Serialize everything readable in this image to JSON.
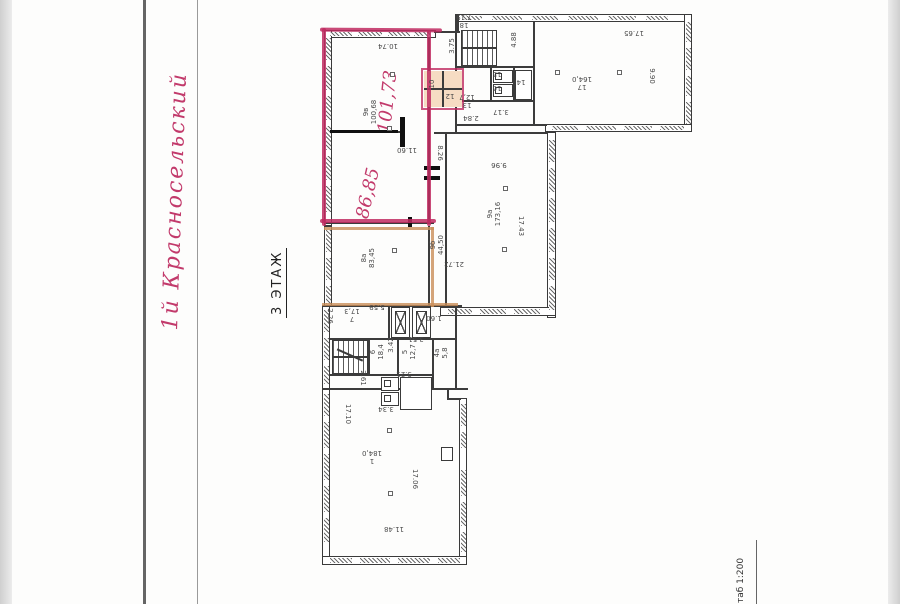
{
  "annotations": {
    "street_handwritten": "1й Красносельский",
    "area_top_handwritten": "101,73",
    "area_bottom_handwritten": "86,85",
    "floor_label": "3 ЭТАЖ",
    "scale_label": "таб 1:200"
  },
  "rooms": [
    {
      "num": "9в",
      "area": "100,68",
      "label": "9в\n100,68"
    },
    {
      "num": "9а",
      "area": "173,16",
      "label": "9а\n173,16"
    },
    {
      "num": "9б",
      "area": "44,50",
      "label": "9б\n44,50"
    },
    {
      "num": "8а",
      "area": "83,45",
      "label": "8а\n83,45"
    },
    {
      "num": "7",
      "area": "17,3",
      "label": "7\n17,3"
    },
    {
      "num": "6",
      "area": "18,4",
      "label": "6\n18,4"
    },
    {
      "num": "5",
      "area": "12,7",
      "label": "5\n12,7"
    },
    {
      "num": "4а",
      "area": "5,8",
      "label": "4а\n5,8"
    },
    {
      "num": "1",
      "area": "184,0",
      "label": "1\n184,0"
    },
    {
      "num": "17",
      "area": "164,0",
      "label": "17\n164,0"
    },
    {
      "num": "13",
      "area": "12,7",
      "label": "13\n12,7"
    },
    {
      "num": "18",
      "area": "7,19",
      "label": "18\n7,19"
    },
    {
      "num": "15",
      "label": "15"
    },
    {
      "num": "16",
      "label": "16"
    },
    {
      "num": "14",
      "label": "14"
    },
    {
      "num": "10",
      "label": "10"
    },
    {
      "num": "12",
      "label": "12"
    }
  ],
  "dims": [
    {
      "v": "3.75"
    },
    {
      "v": "2.84"
    },
    {
      "v": "3.17"
    },
    {
      "v": "4.88"
    },
    {
      "v": "17.65"
    },
    {
      "v": "9.90"
    },
    {
      "v": "8.26"
    },
    {
      "v": "11.60"
    },
    {
      "v": "17.43"
    },
    {
      "v": "9.96"
    },
    {
      "v": "21.72"
    },
    {
      "v": "1.60"
    },
    {
      "v": "5.59"
    },
    {
      "v": "2.26"
    },
    {
      "v": "3.42"
    },
    {
      "v": "3.51"
    },
    {
      "v": "3.21"
    },
    {
      "v": "2.61"
    },
    {
      "v": "3.34"
    },
    {
      "v": "17.10"
    },
    {
      "v": "17.06"
    },
    {
      "v": "11.48"
    },
    {
      "v": "10.74"
    }
  ],
  "colors": {
    "hand_red": "#c23a6b",
    "trace_red": "#bf2a60",
    "trace_orange": "#c98d58",
    "highlight_fill": "#f6dcc3",
    "plan_line": "#3a3a3a"
  }
}
